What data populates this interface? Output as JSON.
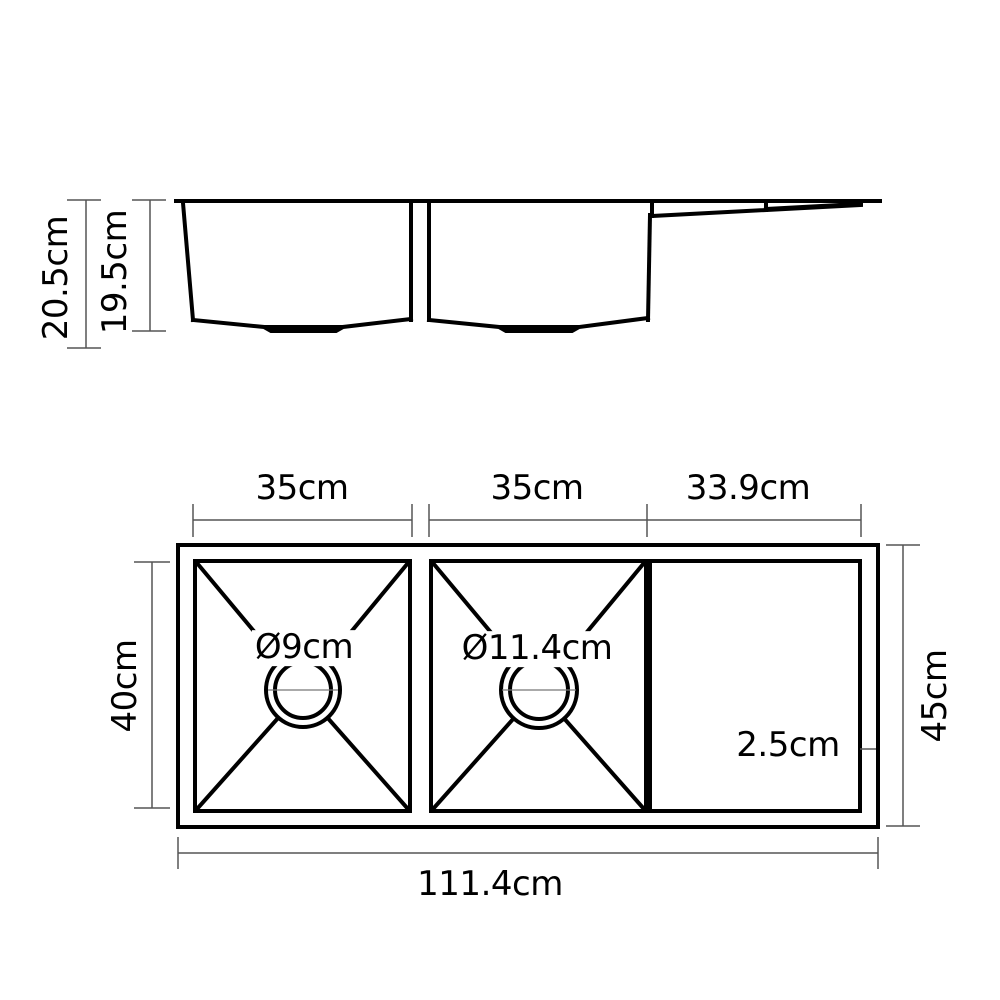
{
  "side_view": {
    "outer_depth": "20.5cm",
    "inner_depth": "19.5cm"
  },
  "top_view": {
    "bowl1_width": "35cm",
    "bowl2_width": "35cm",
    "drainboard_width": "33.9cm",
    "bowl_length": "40cm",
    "overall_depth": "45cm",
    "overall_length": "111.4cm",
    "bowl1_drain_diameter": "Ø9cm",
    "bowl2_drain_diameter": "Ø11.4cm",
    "rim_width": "2.5cm"
  },
  "colors": {
    "outline": "#000000",
    "dimension_line": "#555555",
    "text": "#000000",
    "background": "#ffffff"
  }
}
